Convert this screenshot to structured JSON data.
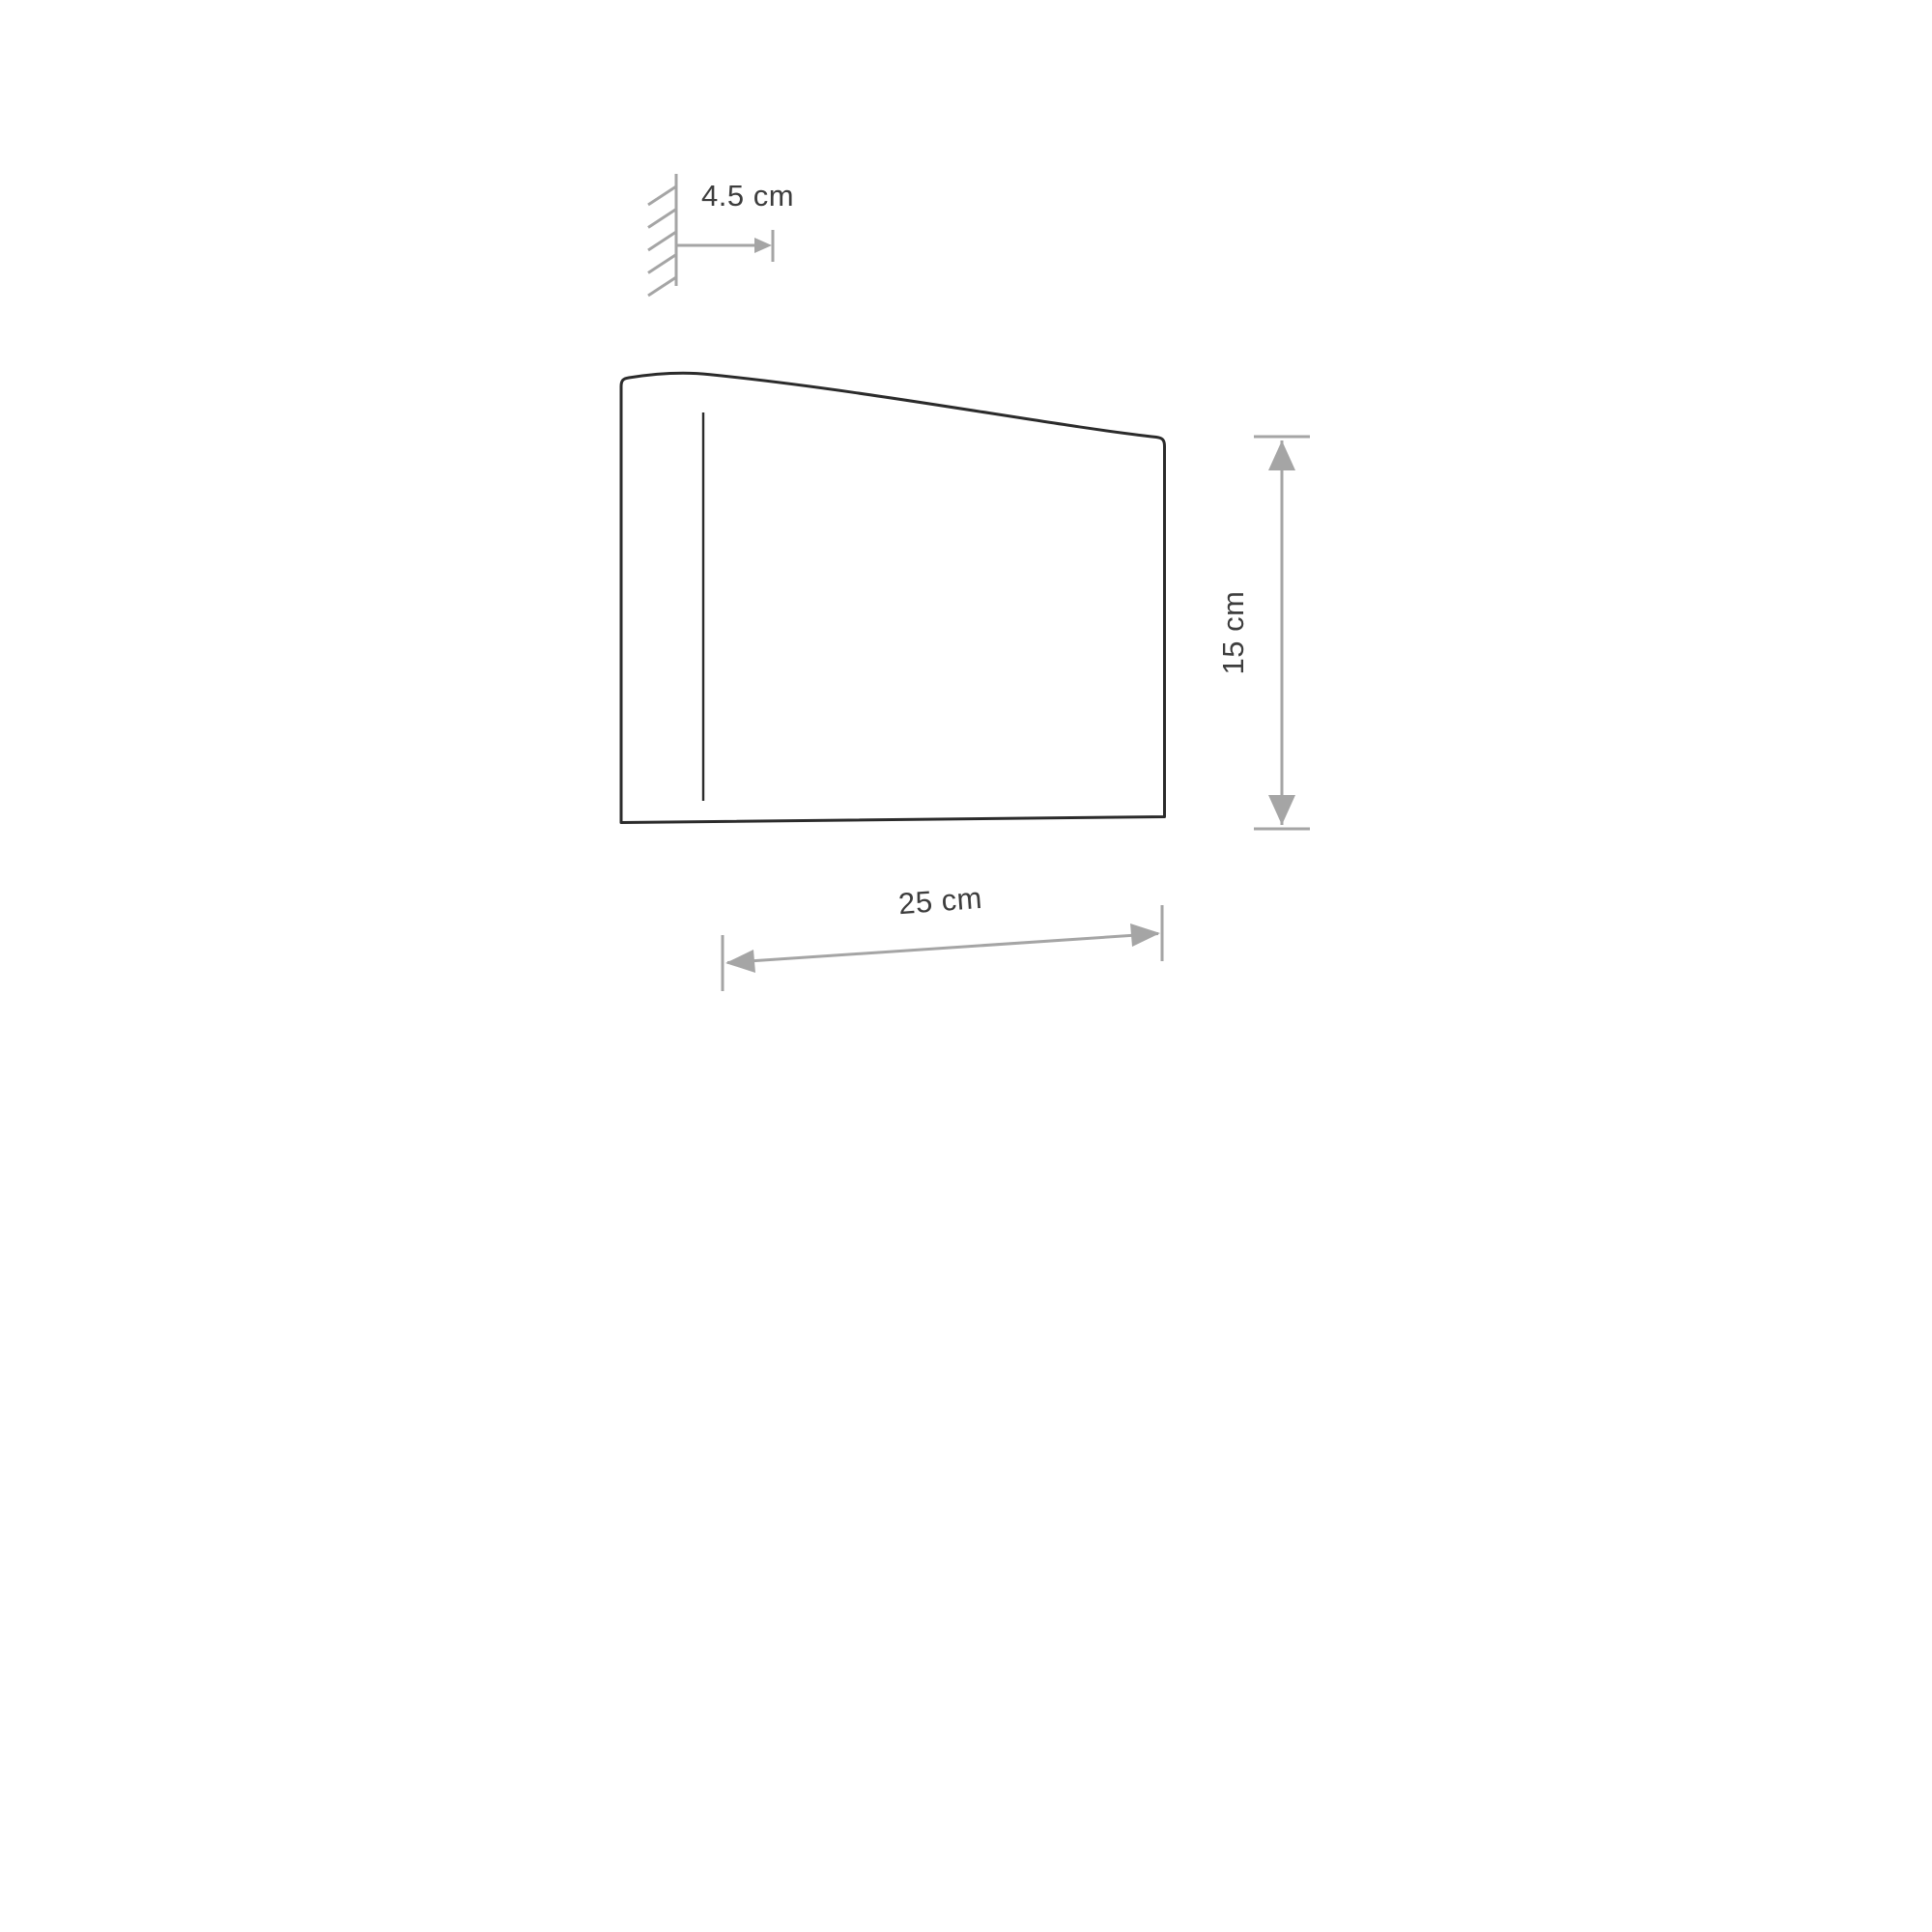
{
  "diagram": {
    "labels": {
      "wall_offset": "4.5 cm",
      "width": "25 cm",
      "height": "15 cm"
    },
    "colors": {
      "background": "#ffffff",
      "outline": "#2b2b2b",
      "dimension": "#a5a5a5",
      "label": "#3d3d3d"
    }
  }
}
